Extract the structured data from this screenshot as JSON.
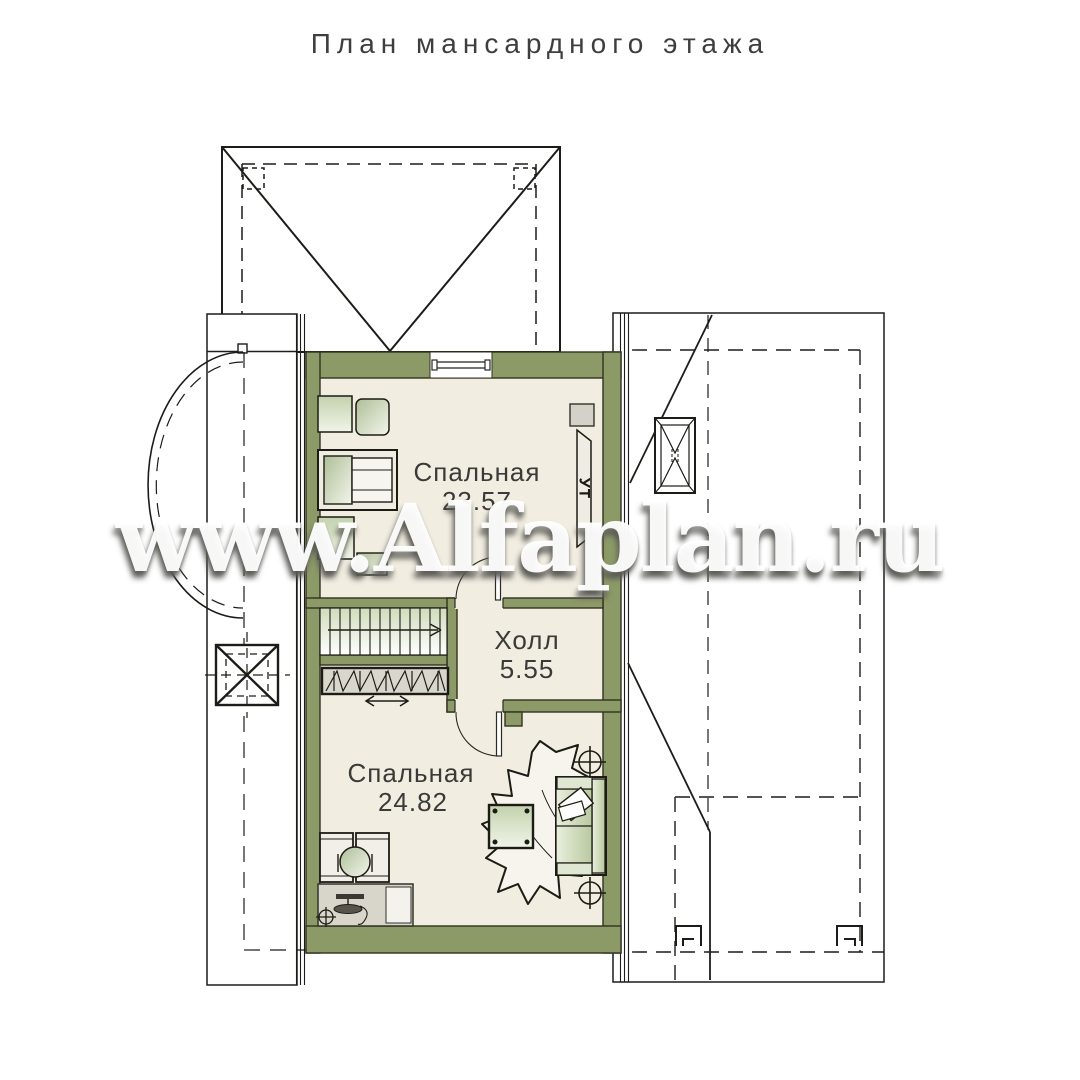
{
  "title": "План мансардного этажа",
  "watermark": "www.Alfaplan.ru",
  "rooms": {
    "bedroom1": {
      "name": "Спальная",
      "area": "23.57"
    },
    "hall": {
      "name": "Холл",
      "area": "5.55"
    },
    "bedroom2": {
      "name": "Спальная",
      "area": "24.82"
    }
  },
  "annotations": {
    "tv_unit": "УТ"
  },
  "colors": {
    "background": "#ffffff",
    "line": "#1c1c18",
    "wall_fill": "#8c9a68",
    "floor_fill": "#f2ede1",
    "furniture_green_dark": "#aebf97",
    "furniture_green_light": "#f3f5ec",
    "furniture_gray": "#d8d5ca",
    "title_text": "#3e3e3c",
    "label_text": "#3a3a38",
    "watermark_text": "#ffffff"
  }
}
